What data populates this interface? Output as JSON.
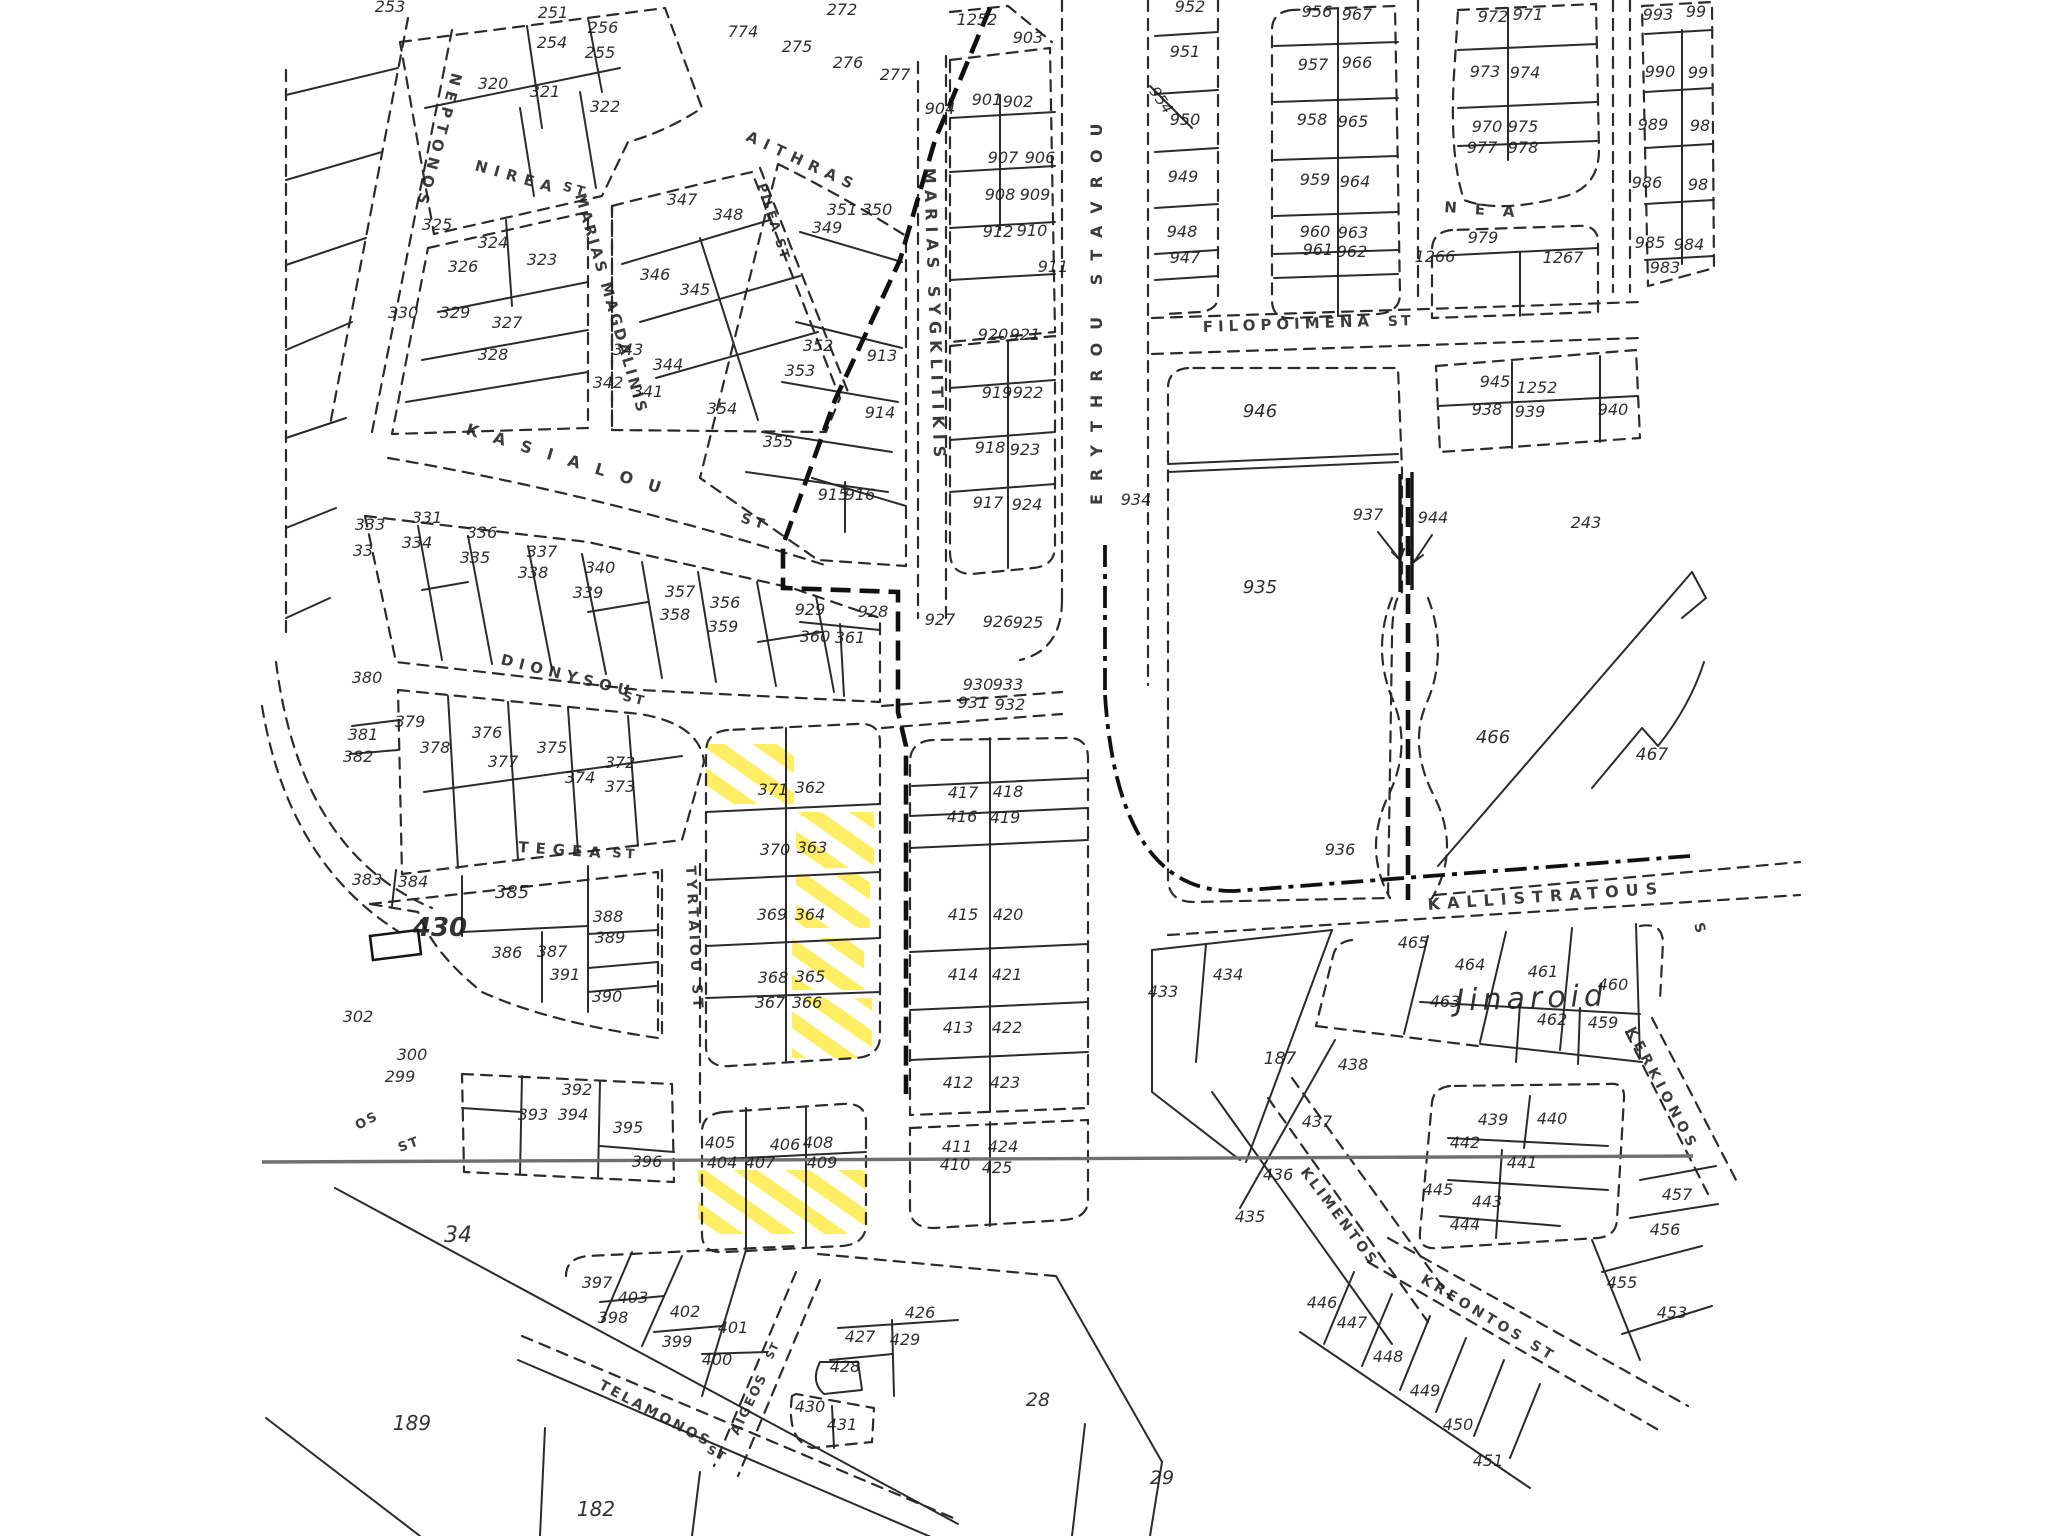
{
  "title": "Cadastral parcel plan with highlighted lots",
  "colors": {
    "ink": "#1c1c1c",
    "highlight": "#ffe93c",
    "gray_line": "#6f6f6f",
    "paper": "#ffffff"
  },
  "highlighted_parcels": [
    "371/362 (corner)",
    "363",
    "364",
    "365",
    "366",
    "404/407/409 (south strip)"
  ],
  "streets": [
    {
      "t": "NEPTONOS",
      "x": 452,
      "y": 72,
      "r": 105,
      "s": 15,
      "ls": 6
    },
    {
      "t": "NIREA",
      "x": 474,
      "y": 170,
      "r": 16,
      "s": 15,
      "ls": 7
    },
    {
      "t": "ST",
      "x": 562,
      "y": 190,
      "r": 16,
      "s": 13,
      "ls": 4
    },
    {
      "t": "AITHRAS",
      "x": 745,
      "y": 140,
      "r": 25,
      "s": 15,
      "ls": 7
    },
    {
      "t": "PILEA ST",
      "x": 757,
      "y": 185,
      "r": 72,
      "s": 13,
      "ls": 2
    },
    {
      "t": "MARIAS MAGDALINIS",
      "x": 575,
      "y": 195,
      "r": 74,
      "s": 15,
      "ls": 3
    },
    {
      "t": "MARIAS SYGKLITIKIS",
      "x": 924,
      "y": 168,
      "r": 88,
      "s": 16,
      "ls": 6
    },
    {
      "t": "ERYTHROU STAVROU",
      "x": 1102,
      "y": 505,
      "r": -90,
      "s": 16,
      "ls": 13
    },
    {
      "t": "FILOPOIMENA",
      "x": 1203,
      "y": 332,
      "r": -2,
      "s": 15,
      "ls": 5
    },
    {
      "t": "ST",
      "x": 1388,
      "y": 326,
      "r": -2,
      "s": 14,
      "ls": 3
    },
    {
      "t": "KASIALOU",
      "x": 465,
      "y": 434,
      "r": 17,
      "s": 16,
      "ls": 16
    },
    {
      "t": "ST",
      "x": 740,
      "y": 522,
      "r": 17,
      "s": 14,
      "ls": 4
    },
    {
      "t": "DIONYSOU",
      "x": 500,
      "y": 664,
      "r": 14,
      "s": 15,
      "ls": 6
    },
    {
      "t": "ST",
      "x": 622,
      "y": 700,
      "r": 14,
      "s": 13,
      "ls": 3
    },
    {
      "t": "TEGEA",
      "x": 518,
      "y": 852,
      "r": 4,
      "s": 15,
      "ls": 7
    },
    {
      "t": "ST",
      "x": 612,
      "y": 857,
      "r": 4,
      "s": 13,
      "ls": 4
    },
    {
      "t": "TYRTAIOU ST",
      "x": 686,
      "y": 866,
      "r": 87,
      "s": 14,
      "ls": 4
    },
    {
      "t": "KALLISTRATOUS",
      "x": 1428,
      "y": 910,
      "r": -4,
      "s": 16,
      "ls": 7
    },
    {
      "t": "S",
      "x": 1694,
      "y": 924,
      "r": 75,
      "s": 14,
      "ls": 0
    },
    {
      "t": "NEA",
      "x": 1444,
      "y": 212,
      "r": 4,
      "s": 15,
      "ls": 18
    },
    {
      "t": "KERKIONOS",
      "x": 1626,
      "y": 1030,
      "r": 62,
      "s": 14,
      "ls": 5
    },
    {
      "t": "KLIMENTOS",
      "x": 1300,
      "y": 1172,
      "r": 53,
      "s": 14,
      "ls": 3
    },
    {
      "t": "KREONTOS ST",
      "x": 1420,
      "y": 1282,
      "r": 31,
      "s": 14,
      "ls": 4
    },
    {
      "t": "TELAMONOS",
      "x": 598,
      "y": 1388,
      "r": 28,
      "s": 14,
      "ls": 3
    },
    {
      "t": "ST",
      "x": 706,
      "y": 1452,
      "r": 28,
      "s": 12,
      "ls": 2
    },
    {
      "t": "AIGEOS",
      "x": 738,
      "y": 1436,
      "r": -64,
      "s": 13,
      "ls": 2
    },
    {
      "t": "ST",
      "x": 772,
      "y": 1360,
      "r": -64,
      "s": 11,
      "ls": 1
    },
    {
      "t": "OS",
      "x": 358,
      "y": 1130,
      "r": -28,
      "s": 13,
      "ls": 2
    },
    {
      "t": "ST",
      "x": 400,
      "y": 1152,
      "r": -20,
      "s": 13,
      "ls": 2
    }
  ],
  "parcels": [
    [
      "253",
      390,
      12
    ],
    [
      "251",
      553,
      18
    ],
    [
      "256",
      603,
      33
    ],
    [
      "254",
      552,
      48
    ],
    [
      "255",
      600,
      58
    ],
    [
      "320",
      493,
      89
    ],
    [
      "321",
      545,
      97
    ],
    [
      "322",
      605,
      112
    ],
    [
      "325",
      437,
      230
    ],
    [
      "324",
      493,
      248
    ],
    [
      "326",
      463,
      272
    ],
    [
      "323",
      542,
      265
    ],
    [
      "330",
      403,
      318
    ],
    [
      "329",
      455,
      318
    ],
    [
      "327",
      507,
      328
    ],
    [
      "328",
      493,
      360
    ],
    [
      "347",
      682,
      205
    ],
    [
      "348",
      728,
      220
    ],
    [
      "346",
      655,
      280
    ],
    [
      "345",
      695,
      295
    ],
    [
      "343",
      628,
      355
    ],
    [
      "344",
      668,
      370
    ],
    [
      "342",
      608,
      388
    ],
    [
      "341",
      648,
      397
    ],
    [
      "349",
      827,
      233
    ],
    [
      "351",
      842,
      215
    ],
    [
      "350",
      877,
      215
    ],
    [
      "352",
      818,
      351
    ],
    [
      "353",
      800,
      376
    ],
    [
      "354",
      722,
      414
    ],
    [
      "355",
      778,
      447
    ],
    [
      "913",
      882,
      361
    ],
    [
      "914",
      880,
      418
    ],
    [
      "915",
      833,
      500
    ],
    [
      "916",
      860,
      500
    ],
    [
      "774",
      743,
      37
    ],
    [
      "272",
      842,
      15
    ],
    [
      "275",
      797,
      52
    ],
    [
      "276",
      848,
      68
    ],
    [
      "277",
      895,
      80
    ],
    [
      "1252",
      977,
      25
    ],
    [
      "903",
      1028,
      43
    ],
    [
      "904",
      940,
      114
    ],
    [
      "901",
      987,
      105
    ],
    [
      "902",
      1018,
      107
    ],
    [
      "907",
      1003,
      163
    ],
    [
      "906",
      1040,
      163
    ],
    [
      "908",
      1000,
      200
    ],
    [
      "909",
      1035,
      200
    ],
    [
      "912",
      998,
      237
    ],
    [
      "910",
      1032,
      236
    ],
    [
      "911",
      1053,
      272
    ],
    [
      "920",
      993,
      340
    ],
    [
      "921",
      1025,
      340
    ],
    [
      "919",
      997,
      398
    ],
    [
      "922",
      1028,
      398
    ],
    [
      "918",
      990,
      453
    ],
    [
      "923",
      1025,
      455
    ],
    [
      "917",
      988,
      508
    ],
    [
      "924",
      1027,
      510
    ],
    [
      "929",
      810,
      615
    ],
    [
      "928",
      873,
      617
    ],
    [
      "360",
      815,
      642
    ],
    [
      "361",
      850,
      643
    ],
    [
      "927",
      940,
      625
    ],
    [
      "926",
      998,
      627
    ],
    [
      "925",
      1028,
      628
    ],
    [
      "930",
      978,
      690
    ],
    [
      "933",
      1008,
      690
    ],
    [
      "931",
      973,
      708
    ],
    [
      "932",
      1010,
      710
    ],
    [
      "934",
      1136,
      505
    ],
    [
      "952",
      1190,
      12
    ],
    [
      "951",
      1185,
      57
    ],
    [
      "954",
      1157,
      103,
      15,
      55
    ],
    [
      "950",
      1185,
      125
    ],
    [
      "949",
      1183,
      182
    ],
    [
      "948",
      1182,
      237
    ],
    [
      "947",
      1185,
      263
    ],
    [
      "956",
      1317,
      17
    ],
    [
      "967",
      1357,
      20
    ],
    [
      "957",
      1313,
      70
    ],
    [
      "966",
      1357,
      68
    ],
    [
      "958",
      1312,
      125
    ],
    [
      "965",
      1353,
      127
    ],
    [
      "959",
      1315,
      185
    ],
    [
      "964",
      1355,
      187
    ],
    [
      "960",
      1315,
      237
    ],
    [
      "963",
      1353,
      238
    ],
    [
      "961",
      1318,
      255
    ],
    [
      "962",
      1352,
      257
    ],
    [
      "972",
      1493,
      22
    ],
    [
      "971",
      1528,
      20
    ],
    [
      "973",
      1485,
      77
    ],
    [
      "974",
      1525,
      78
    ],
    [
      "970",
      1487,
      132
    ],
    [
      "975",
      1523,
      132
    ],
    [
      "977",
      1482,
      153
    ],
    [
      "978",
      1523,
      153
    ],
    [
      "979",
      1483,
      243
    ],
    [
      "1266",
      1435,
      262
    ],
    [
      "1267",
      1563,
      263
    ],
    [
      "993",
      1658,
      20
    ],
    [
      "99",
      1696,
      17
    ],
    [
      "990",
      1660,
      77
    ],
    [
      "99",
      1698,
      78
    ],
    [
      "989",
      1653,
      130
    ],
    [
      "98",
      1700,
      131
    ],
    [
      "986",
      1647,
      188
    ],
    [
      "98",
      1698,
      190
    ],
    [
      "985",
      1650,
      248
    ],
    [
      "984",
      1689,
      250
    ],
    [
      "983",
      1665,
      273
    ],
    [
      "945",
      1495,
      387
    ],
    [
      "1252",
      1537,
      393
    ],
    [
      "938",
      1487,
      415
    ],
    [
      "939",
      1530,
      417
    ],
    [
      "940",
      1613,
      415
    ],
    [
      "946",
      1260,
      417,
      18
    ],
    [
      "937",
      1368,
      520
    ],
    [
      "944",
      1433,
      523
    ],
    [
      "935",
      1260,
      593,
      18
    ],
    [
      "466",
      1493,
      743,
      18
    ],
    [
      "467",
      1652,
      760,
      17
    ],
    [
      "936",
      1340,
      855
    ],
    [
      "331",
      427,
      523
    ],
    [
      "333",
      370,
      530
    ],
    [
      "334",
      417,
      548
    ],
    [
      "33",
      363,
      556
    ],
    [
      "336",
      482,
      538
    ],
    [
      "335",
      475,
      563
    ],
    [
      "337",
      542,
      557
    ],
    [
      "338",
      533,
      578
    ],
    [
      "340",
      600,
      573
    ],
    [
      "339",
      588,
      598
    ],
    [
      "357",
      680,
      597
    ],
    [
      "356",
      725,
      608
    ],
    [
      "358",
      675,
      620
    ],
    [
      "359",
      723,
      632
    ],
    [
      "380",
      367,
      683
    ],
    [
      "379",
      410,
      727
    ],
    [
      "381",
      363,
      740
    ],
    [
      "382",
      358,
      762
    ],
    [
      "378",
      435,
      753
    ],
    [
      "376",
      487,
      738
    ],
    [
      "377",
      503,
      767
    ],
    [
      "375",
      552,
      753
    ],
    [
      "374",
      580,
      783
    ],
    [
      "372",
      620,
      768
    ],
    [
      "373",
      620,
      792
    ],
    [
      "383",
      367,
      885
    ],
    [
      "384",
      413,
      887
    ],
    [
      "385",
      512,
      898,
      18
    ],
    [
      "388",
      608,
      922
    ],
    [
      "389",
      610,
      943
    ],
    [
      "386",
      507,
      958
    ],
    [
      "387",
      552,
      957
    ],
    [
      "391",
      565,
      980
    ],
    [
      "390",
      607,
      1002
    ],
    [
      "302",
      358,
      1022
    ],
    [
      "300",
      412,
      1060
    ],
    [
      "299",
      400,
      1082
    ],
    [
      "371",
      773,
      795
    ],
    [
      "362",
      810,
      793
    ],
    [
      "370",
      775,
      855
    ],
    [
      "363",
      812,
      853
    ],
    [
      "369",
      772,
      920
    ],
    [
      "364",
      810,
      920
    ],
    [
      "368",
      773,
      983
    ],
    [
      "365",
      810,
      982
    ],
    [
      "367",
      770,
      1008
    ],
    [
      "366",
      807,
      1008
    ],
    [
      "417",
      963,
      798
    ],
    [
      "418",
      1008,
      797
    ],
    [
      "416",
      962,
      822
    ],
    [
      "419",
      1005,
      823
    ],
    [
      "415",
      963,
      920
    ],
    [
      "420",
      1008,
      920
    ],
    [
      "414",
      963,
      980
    ],
    [
      "421",
      1007,
      980
    ],
    [
      "413",
      958,
      1033
    ],
    [
      "422",
      1007,
      1033
    ],
    [
      "412",
      958,
      1088
    ],
    [
      "423",
      1005,
      1088
    ],
    [
      "411",
      957,
      1152
    ],
    [
      "424",
      1003,
      1152
    ],
    [
      "410",
      955,
      1170
    ],
    [
      "425",
      997,
      1173
    ],
    [
      "433",
      1163,
      997
    ],
    [
      "434",
      1228,
      980
    ],
    [
      "465",
      1413,
      948
    ],
    [
      "464",
      1470,
      970
    ],
    [
      "461",
      1543,
      977
    ],
    [
      "460",
      1613,
      990
    ],
    [
      "463",
      1445,
      1007
    ],
    [
      "462",
      1552,
      1025
    ],
    [
      "459",
      1603,
      1028
    ],
    [
      "457",
      1677,
      1200
    ],
    [
      "456",
      1665,
      1235
    ],
    [
      "455",
      1622,
      1288
    ],
    [
      "453",
      1672,
      1318
    ],
    [
      "435",
      1250,
      1222
    ],
    [
      "436",
      1278,
      1180
    ],
    [
      "437",
      1317,
      1127
    ],
    [
      "438",
      1353,
      1070
    ],
    [
      "439",
      1493,
      1125
    ],
    [
      "440",
      1552,
      1124
    ],
    [
      "442",
      1465,
      1148
    ],
    [
      "441",
      1522,
      1168
    ],
    [
      "445",
      1438,
      1195
    ],
    [
      "443",
      1487,
      1207
    ],
    [
      "444",
      1465,
      1230
    ],
    [
      "446",
      1322,
      1308
    ],
    [
      "447",
      1352,
      1328
    ],
    [
      "448",
      1388,
      1362
    ],
    [
      "449",
      1425,
      1396
    ],
    [
      "450",
      1458,
      1430
    ],
    [
      "451",
      1488,
      1466
    ],
    [
      "392",
      577,
      1095
    ],
    [
      "393",
      533,
      1120
    ],
    [
      "394",
      573,
      1120
    ],
    [
      "395",
      628,
      1133
    ],
    [
      "396",
      647,
      1167
    ],
    [
      "405",
      720,
      1148
    ],
    [
      "406",
      785,
      1150
    ],
    [
      "408",
      818,
      1148
    ],
    [
      "404",
      722,
      1168
    ],
    [
      "407",
      760,
      1168
    ],
    [
      "409",
      822,
      1168
    ],
    [
      "397",
      597,
      1288
    ],
    [
      "403",
      633,
      1303
    ],
    [
      "398",
      613,
      1323
    ],
    [
      "402",
      685,
      1317
    ],
    [
      "399",
      677,
      1347
    ],
    [
      "401",
      733,
      1333
    ],
    [
      "400",
      717,
      1365
    ],
    [
      "427",
      860,
      1342
    ],
    [
      "426",
      920,
      1318
    ],
    [
      "429",
      905,
      1345
    ],
    [
      "428",
      845,
      1372
    ],
    [
      "430",
      810,
      1412
    ],
    [
      "431",
      842,
      1430
    ],
    [
      "243",
      1586,
      528,
      16
    ],
    [
      "187",
      1280,
      1064,
      17
    ]
  ],
  "area_labels": [
    {
      "t": "Jinaroid",
      "x": 1532,
      "y": 1008,
      "s": 30,
      "ls": 5,
      "r": -2
    },
    {
      "t": "430",
      "x": 440,
      "y": 936,
      "s": 26,
      "w": "bold"
    },
    {
      "t": "34",
      "x": 458,
      "y": 1242,
      "s": 22
    },
    {
      "t": "189",
      "x": 412,
      "y": 1430,
      "s": 20
    },
    {
      "t": "182",
      "x": 596,
      "y": 1516,
      "s": 20
    },
    {
      "t": "28",
      "x": 1038,
      "y": 1406,
      "s": 19
    },
    {
      "t": "29",
      "x": 1162,
      "y": 1484,
      "s": 19
    }
  ],
  "highlights": [
    {
      "parcel": "371-362-corner",
      "x": 706,
      "y": 744,
      "w": 88,
      "h": 60
    },
    {
      "parcel": "363",
      "x": 796,
      "y": 812,
      "w": 78,
      "h": 56
    },
    {
      "parcel": "364",
      "x": 796,
      "y": 874,
      "w": 74,
      "h": 54
    },
    {
      "parcel": "365",
      "x": 792,
      "y": 938,
      "w": 72,
      "h": 52
    },
    {
      "parcel": "366",
      "x": 792,
      "y": 998,
      "w": 80,
      "h": 60
    },
    {
      "parcel": "404-407-409-south",
      "x": 698,
      "y": 1170,
      "w": 168,
      "h": 64
    }
  ]
}
